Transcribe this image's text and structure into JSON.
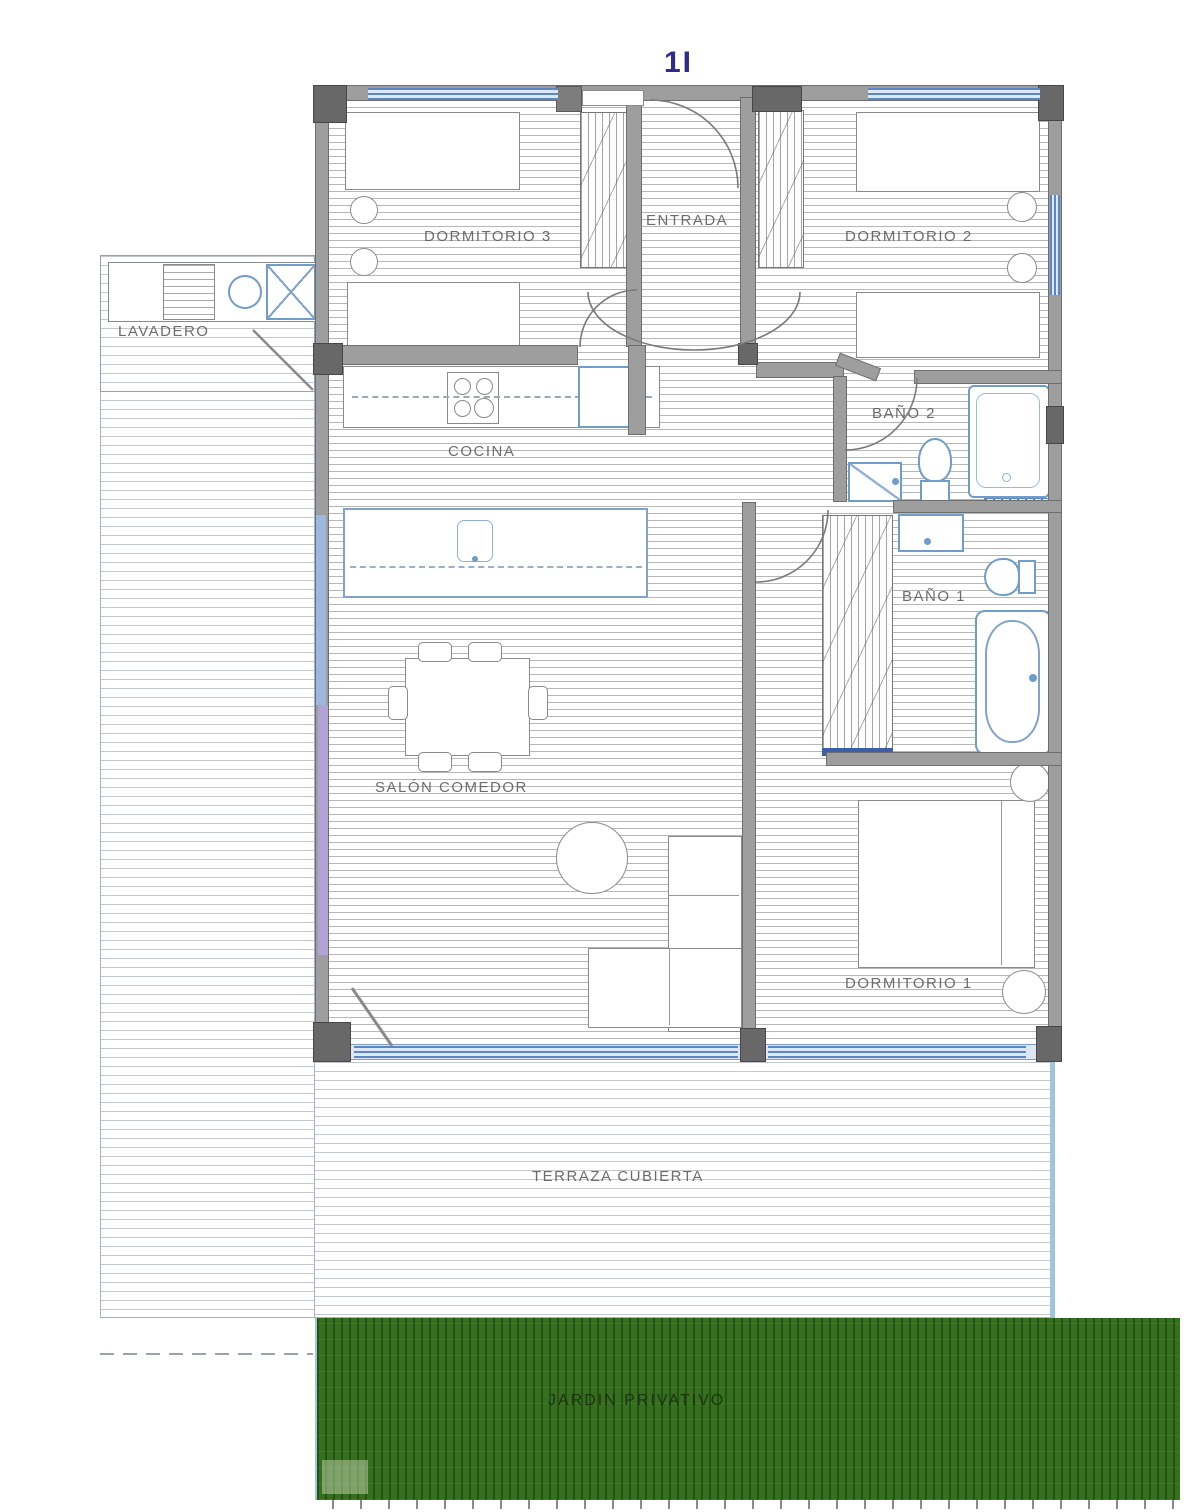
{
  "plan": {
    "unit_label": "1I",
    "rooms": {
      "dormitorio3": {
        "label": "DORMITORIO 3"
      },
      "entrada": {
        "label": "ENTRADA"
      },
      "dormitorio2": {
        "label": "DORMITORIO 2"
      },
      "lavadero": {
        "label": "LAVADERO"
      },
      "cocina": {
        "label": "COCINA"
      },
      "bano2": {
        "label": "BAÑO 2"
      },
      "bano1": {
        "label": "BAÑO 1"
      },
      "salon": {
        "label": "SALÓN COMEDOR"
      },
      "dormitorio1": {
        "label": "DORMITORIO 1"
      },
      "terraza": {
        "label": "TERRAZA CUBIERTA"
      },
      "jardin": {
        "label": "JARDIN PRIVATIVO"
      }
    },
    "colors": {
      "wall": "#9e9e9e",
      "pillar": "#686868",
      "fixture_blue": "#6f9cc9",
      "window_blue": "#5b87c5",
      "garden_green": "#35701f",
      "label_gray": "#5a5a5a",
      "unit_label_color": "#2d2d8f"
    }
  }
}
